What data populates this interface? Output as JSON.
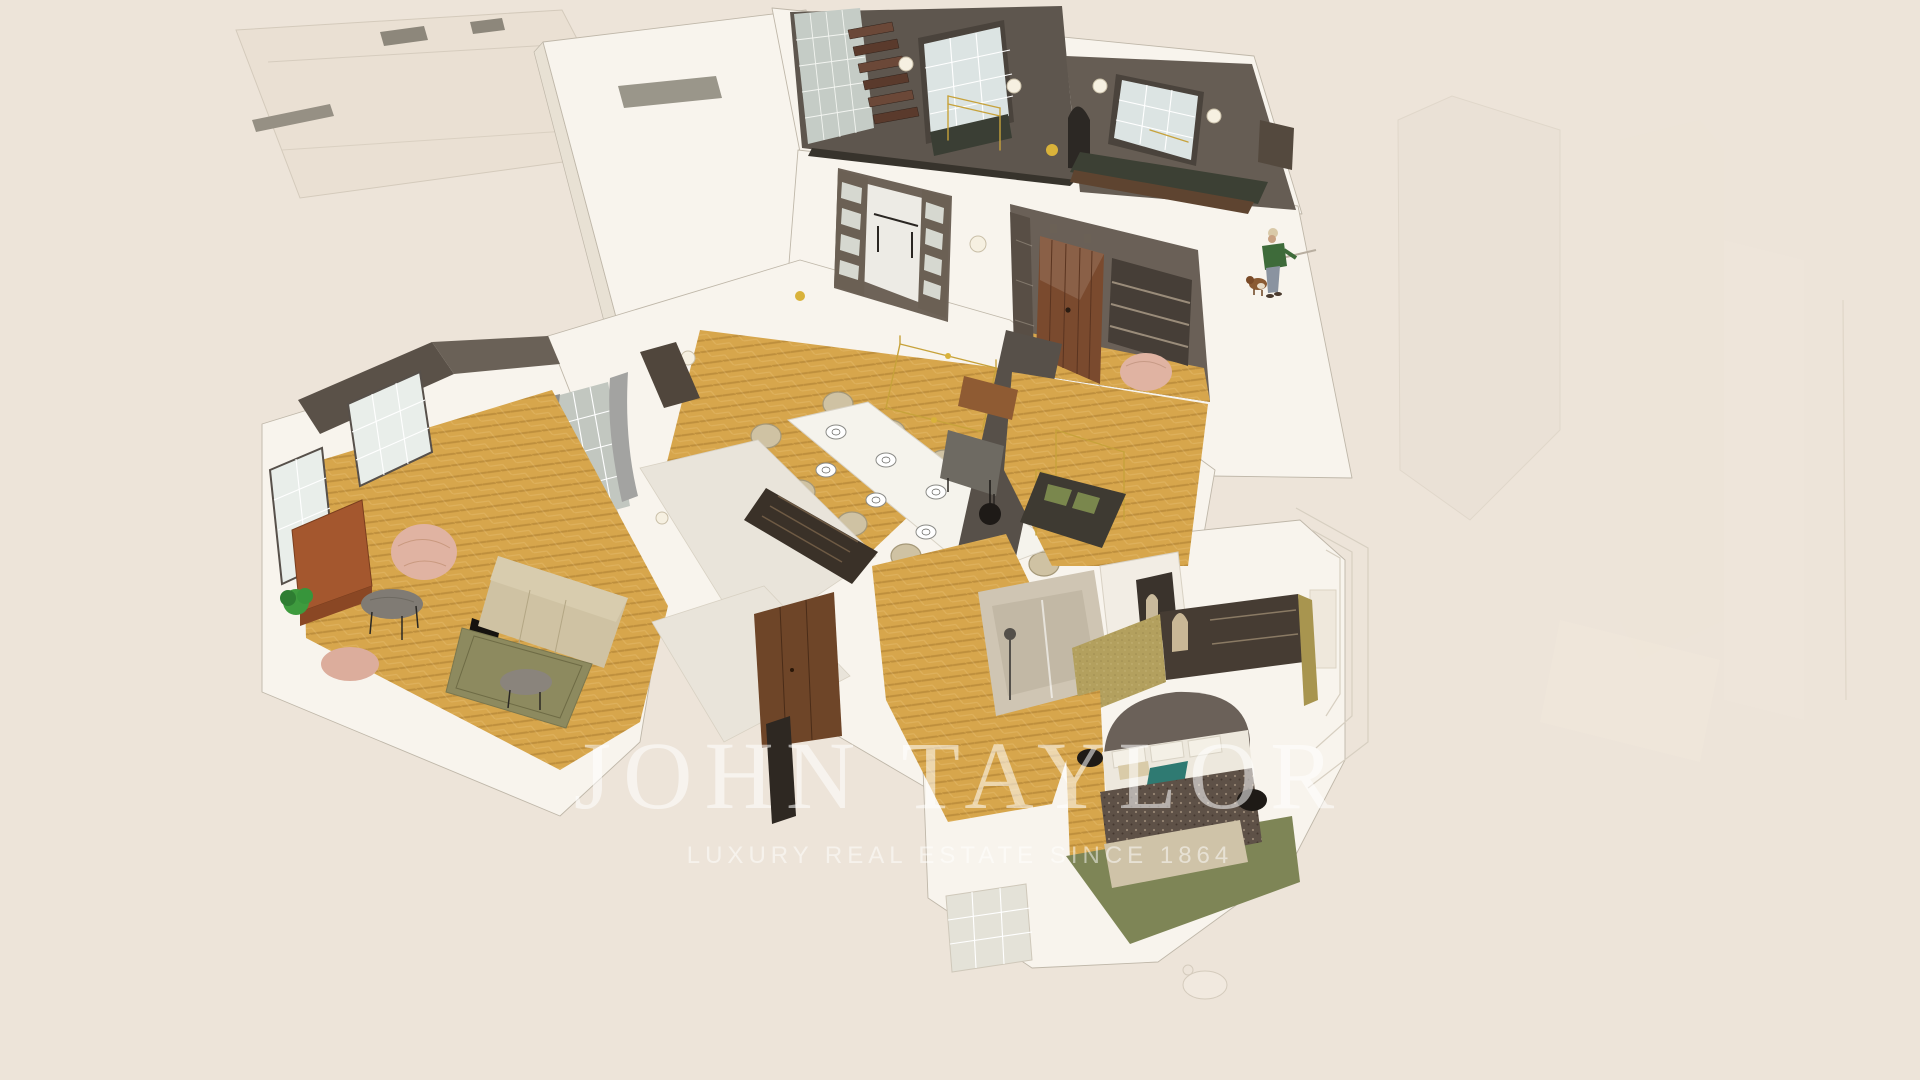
{
  "watermark": {
    "brand": "JOHN TAYLOR",
    "tagline": "LUXURY REAL ESTATE SINCE 1864"
  },
  "palette": {
    "background": "#EDE4D9",
    "wall-white": "#F8F4ED",
    "wall-shade": "#E8E1D4",
    "outline": "#BFB7A9",
    "floor-gold": "#D7A64C",
    "dark-taupe": "#5E564E",
    "taupe-mid": "#6A6057",
    "walnut": "#7A4A2E",
    "stair-wood": "#654437",
    "window-pale": "#DCE4E3",
    "curtain-gray": "#8E8E8C",
    "sofa-beige": "#CFC2A3",
    "rug-olive": "#8D8A5F",
    "blush": "#E0B3A2",
    "teal": "#2F7A72",
    "blanket-brown": "#5E5147",
    "wallpaper-olive": "#B3A05E",
    "brass": "#C7A23B",
    "plant-green": "#3E9B3E",
    "person-green": "#3E6B3A",
    "watermark-white": "rgba(255,255,255,0.55)",
    "tagline-white": "rgba(255,255,255,0.50)"
  },
  "figures": {
    "person": "standing-person-with-cap",
    "dog": "small-dog"
  }
}
